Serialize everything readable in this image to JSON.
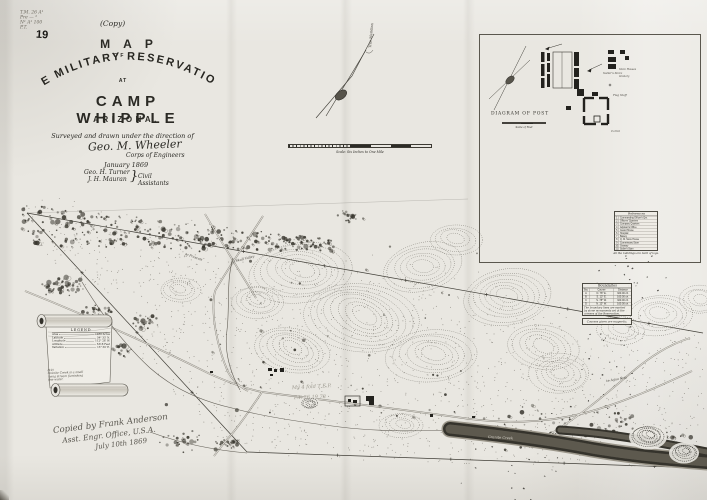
{
  "corner_note": {
    "line1": "T.M. 26 A¹",
    "line2": "Pre — ²",
    "line3": "N¹ A¹ 100",
    "line4": "P.T.",
    "number": "19"
  },
  "title_block": {
    "copy": "(Copy)",
    "map": "MAP",
    "of": "OF",
    "reservation": "THE MILITARY RESERVATION",
    "at": "AT",
    "camp": "CAMP WHIPPLE",
    "state": "ARIZONA.",
    "surveyed": "Surveyed and drawn under the direction of",
    "signature": "Geo. M. Wheeler",
    "corps": "Corps of Engineers",
    "date": "January 1869",
    "assistant1": "Geo. H. Turner",
    "assistant2": "J. H. Mauran",
    "brace": "}",
    "assistants_role": "Civil Assistants"
  },
  "meridian": {
    "label": "True Meridian"
  },
  "scale_bar": {
    "caption": "Scale: Six Inches to One Mile"
  },
  "inset": {
    "title": "DIAGRAM OF POST",
    "scale_caption": "Scale of Feet",
    "labels": {
      "flag": "Flag Staff",
      "sutler": "Sutler's Store",
      "stores": "Store Houses",
      "granary": "Granary",
      "corral": "Corral"
    },
    "references": {
      "title": "References",
      "rows": [
        {
          "num": "1",
          "label": "Commanding Officer's Qrs."
        },
        {
          "num": "2",
          "label": "Officers' Quarters"
        },
        {
          "num": "3",
          "label": "Company Quarters"
        },
        {
          "num": "4",
          "label": "Adjutant's Office"
        },
        {
          "num": "5",
          "label": "Guard House"
        },
        {
          "num": "6",
          "label": "Hospital"
        },
        {
          "num": "7",
          "label": "Bakery"
        },
        {
          "num": "8",
          "label": "Q. M. Store House"
        },
        {
          "num": "9",
          "label": "Commissary Store"
        },
        {
          "num": "10",
          "label": "Granary"
        },
        {
          "num": "11",
          "label": "Sutler's Store"
        },
        {
          "num": "12",
          "label": "Stables"
        }
      ],
      "footer": "All the buildings are built of logs."
    }
  },
  "survey_table": {
    "title": "Boundaries",
    "headers": {
      "c1": "Sta.",
      "c2": "Course",
      "c3": "Distance"
    },
    "rows": [
      {
        "c1": "A",
        "c2": "N. 78° E.",
        "c3": "320.00 ch."
      },
      {
        "c1": "B",
        "c2": "S. 12° E.",
        "c3": "160.00 ch."
      },
      {
        "c1": "C",
        "c2": "S. 78° W.",
        "c3": "320.00 ch."
      },
      {
        "c1": "D",
        "c2": "N. 12° W.",
        "c3": "160.00 ch."
      }
    ],
    "notes": {
      "line1": "The boundary lines are marked",
      "line2": "by stone monuments set at the",
      "line3": "corners of the Reservation."
    },
    "footer": "Courses given are magnetic."
  },
  "scroll_legend": {
    "title": "LEGEND",
    "rows": [
      {
        "label": "Area",
        "value": "1280 Acres"
      },
      {
        "label": "Latitude",
        "value": "34° 33′ N."
      },
      {
        "label": "Longitude",
        "value": "112° 28′ W."
      },
      {
        "label": "Altitude",
        "value": "5318 Feet"
      },
      {
        "label": "Variation",
        "value": "13° 30′ E."
      }
    ],
    "note1": "(19)",
    "note2": "Granite Creek is a small",
    "note3": "living stream furnishing",
    "note4": "fine water."
  },
  "pencil_note": {
    "line1": "My 4 fold T E.P.",
    "line2": "P.T. 26 19 78"
  },
  "copied_note": {
    "line1": "Copied by Frank Anderson",
    "line2": "Asst. Engr. Office, U.S.A.",
    "line3": "July 10th 1869"
  },
  "map_labels": {
    "prescott": "to Prescott",
    "skull": "to Skull Valley",
    "agua": "to Agua Fria",
    "creek": "Granite Creek"
  },
  "colors": {
    "paper": "#e9e7e1",
    "ink": "#2b2a25",
    "pencil": "#8f8b80"
  }
}
